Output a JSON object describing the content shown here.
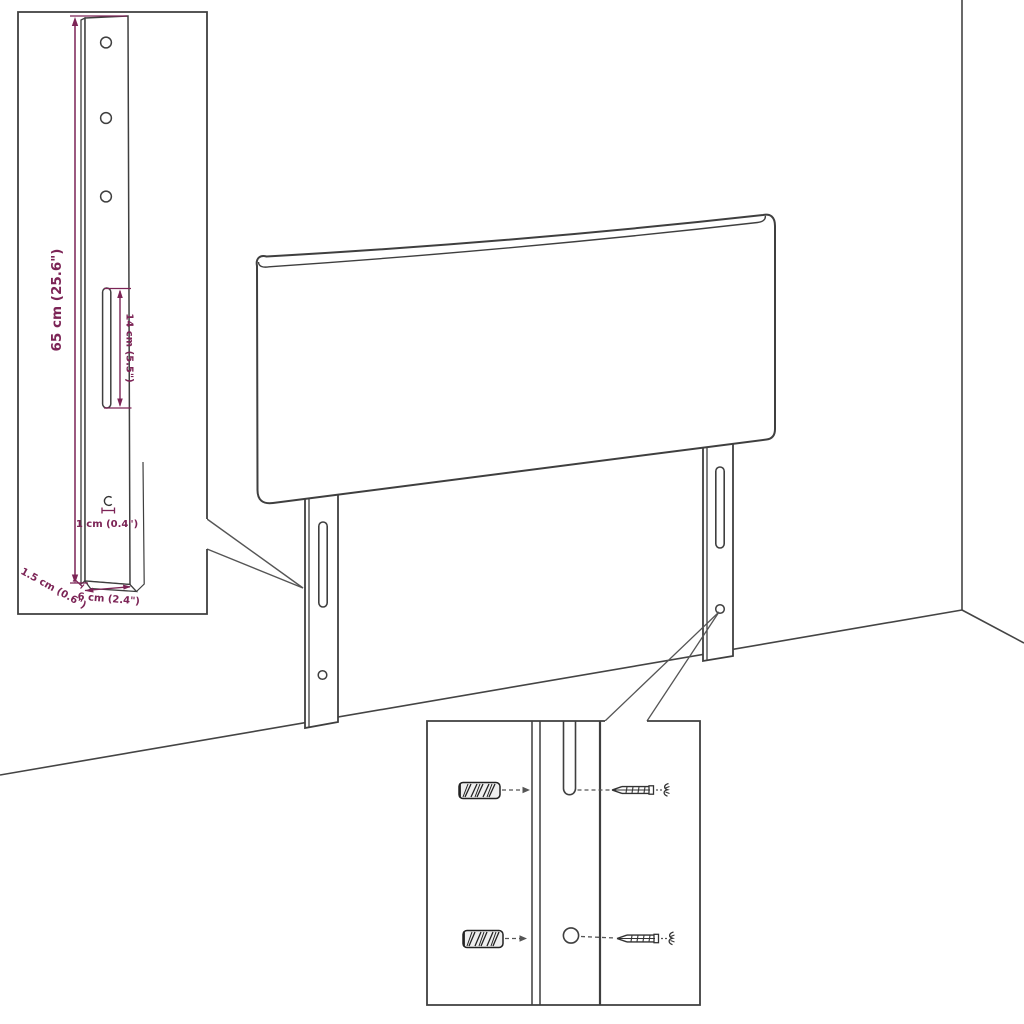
{
  "page": {
    "background": "#ffffff"
  },
  "diagram": {
    "type": "furniture-assembly-dimension-diagram",
    "subject": "upholstered headboard with two mounting legs, wall-corner backdrop, bracket dimension inset and screw/wall-plug detail inset",
    "colors": {
      "line": "#3f3f3f",
      "dimension_accent": "#7c2456",
      "background": "#ffffff"
    },
    "dimensions": {
      "leg_height": "65 cm (25.6\")",
      "slot_length": "14 cm (5.5\")",
      "hole_diameter": "1 cm (0.4\")",
      "leg_depth": "1.5 cm (0.6\")",
      "leg_width": "6 cm (2.4\")"
    }
  }
}
